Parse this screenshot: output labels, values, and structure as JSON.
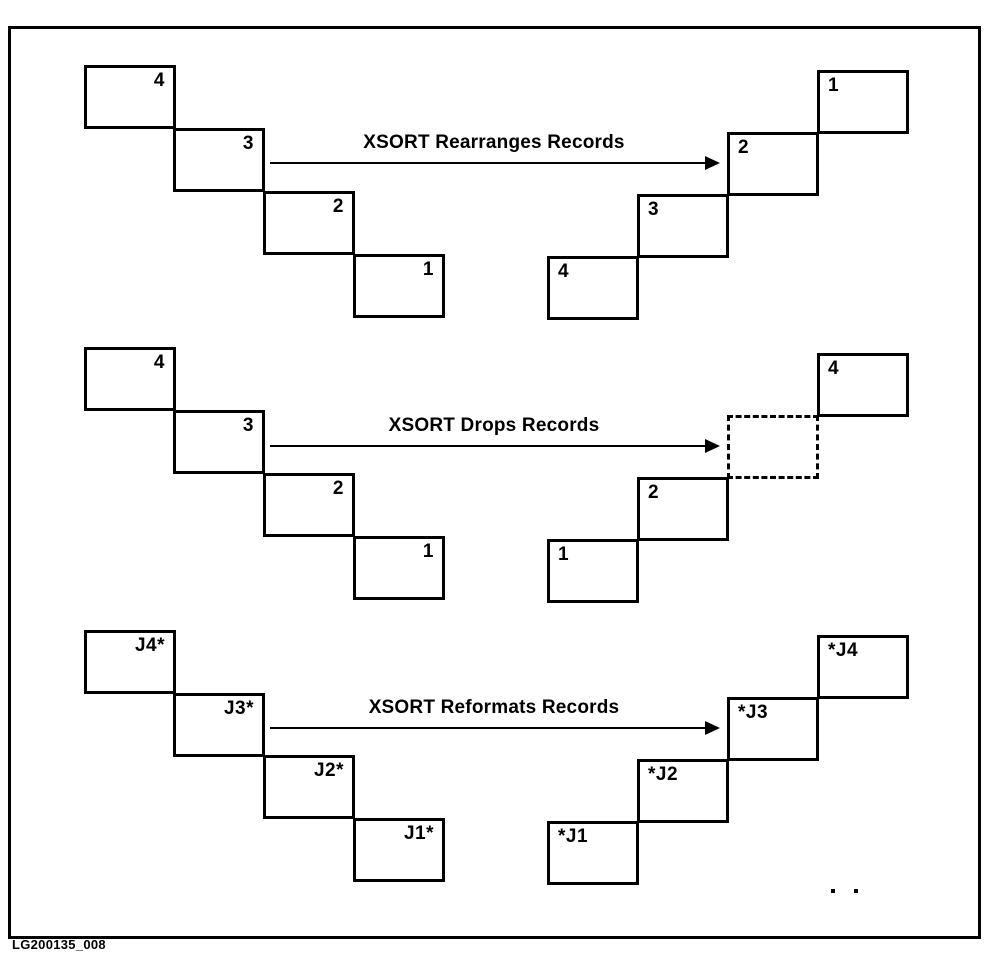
{
  "figure": {
    "caption": "LG200135_008"
  },
  "sections": [
    {
      "arrow_label": "XSORT Rearranges Records",
      "input_labels": [
        "4",
        "3",
        "2",
        "1"
      ],
      "output_labels": [
        "1",
        "2",
        "3",
        "4"
      ]
    },
    {
      "arrow_label": "XSORT Drops Records",
      "input_labels": [
        "4",
        "3",
        "2",
        "1"
      ],
      "output_labels": [
        "4",
        "2",
        "1"
      ]
    },
    {
      "arrow_label": "XSORT Reformats Records",
      "input_labels": [
        "J4*",
        "J3*",
        "J2*",
        "J1*"
      ],
      "output_labels": [
        "*J4",
        "*J3",
        "*J2",
        "*J1"
      ]
    }
  ]
}
